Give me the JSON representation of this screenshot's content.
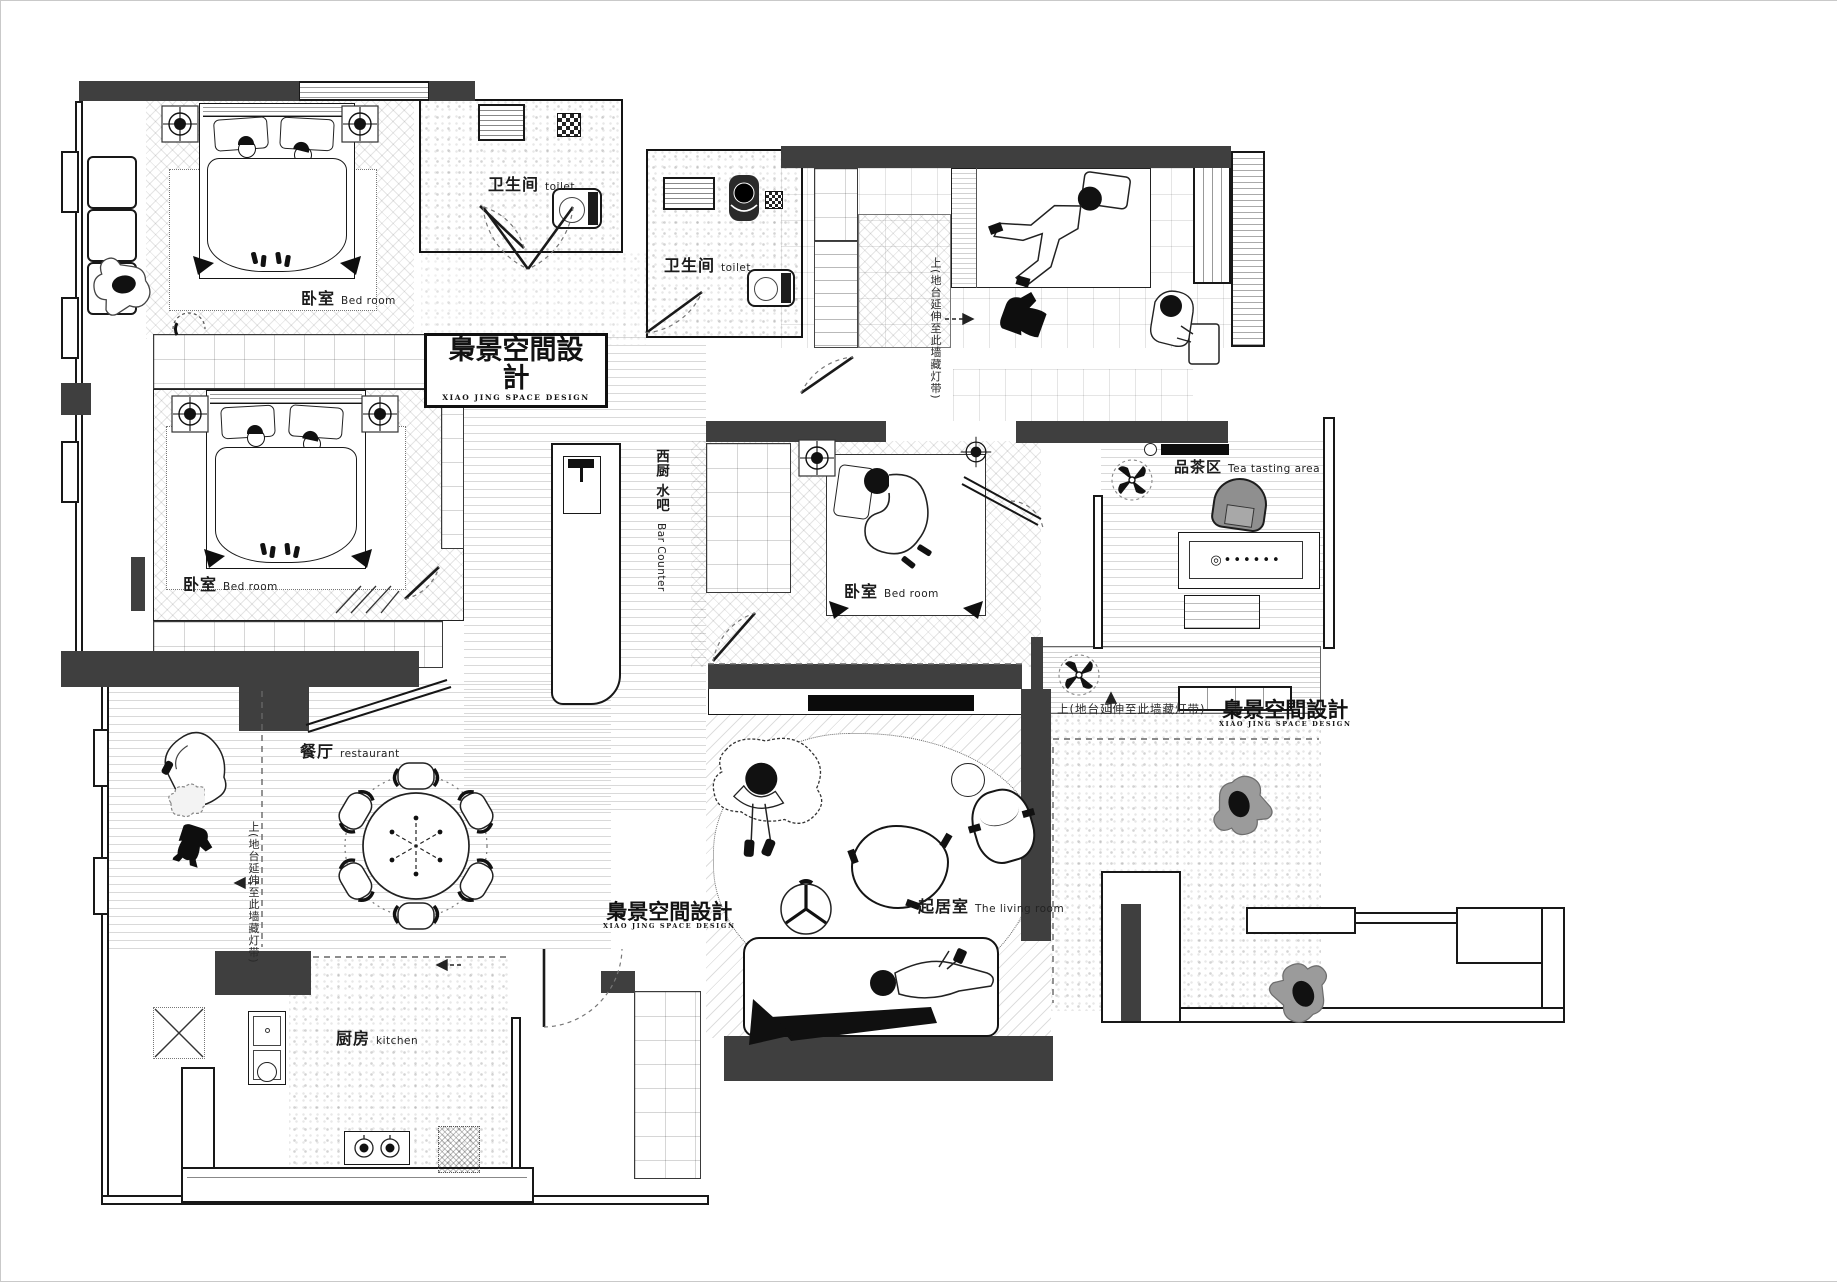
{
  "brand": {
    "cn": "梟景空間設計",
    "en": "XIAO JING SPACE DESIGN"
  },
  "rooms": {
    "bedroom_top": {
      "cn": "卧室",
      "en": "Bed room"
    },
    "bedroom_mid": {
      "cn": "卧室",
      "en": "Bed room"
    },
    "bedroom_small": {
      "cn": "卧室",
      "en": "Bed room"
    },
    "toilet_top": {
      "cn": "卫生间",
      "en": "toilet"
    },
    "toilet_inner": {
      "cn": "卫生间",
      "en": "toilet"
    },
    "tea_area": {
      "cn": "品茶区",
      "en": "Tea tasting area"
    },
    "dining": {
      "cn": "餐厅",
      "en": "restaurant"
    },
    "kitchen": {
      "cn": "厨房",
      "en": "kitchen"
    },
    "living": {
      "cn": "起居室",
      "en": "The living room"
    },
    "bar_counter": {
      "cn": "西厨 水吧",
      "en": "Bar Counter"
    }
  },
  "annotations": {
    "platform_note": "上(地台延伸至此墙藏灯带)",
    "tea_set_dots": "◎••••••"
  },
  "colors": {
    "wall_fill": "#3f3f3f",
    "line": "#171717",
    "figure_gray": "#9a9a9a",
    "paper": "#ffffff"
  }
}
